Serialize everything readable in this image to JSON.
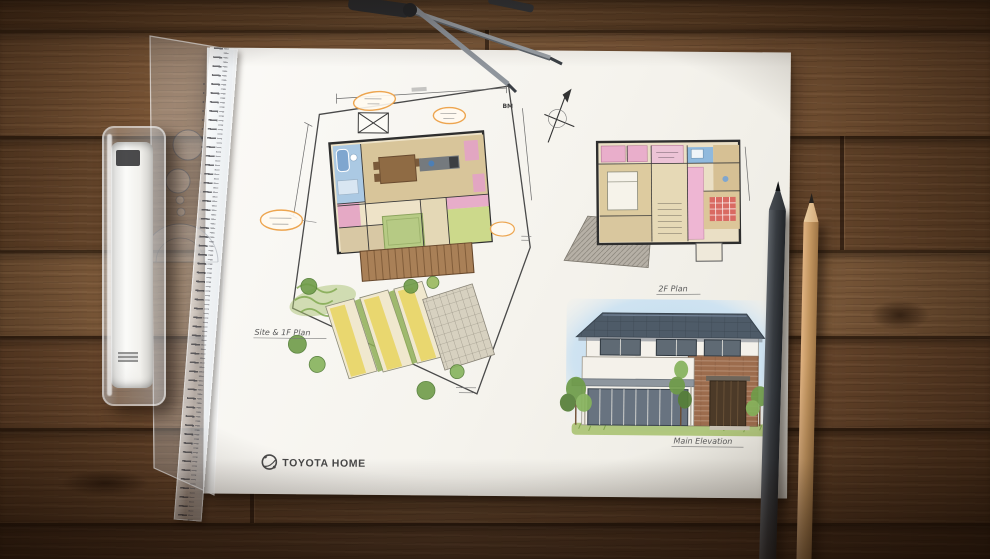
{
  "drawing": {
    "logo": {
      "text": "TOYOTA HOME"
    },
    "labels": {
      "site_plan": "Site & 1F Plan",
      "floor_2": "2F Plan",
      "elevation": "Main Elevation",
      "benchmark": "BM"
    }
  },
  "objects": {
    "tube": "document-tube",
    "template": "protractor-template",
    "ruler": "clear-ruler",
    "divider": "drafting-divider",
    "pencil_dark": "charcoal-pencil",
    "pencil_wood": "graphite-pencil"
  },
  "colors": {
    "wood": "#7b5334",
    "paper": "#f6f4ef",
    "roof": "#4e5b68",
    "brick": "#9c6c4d",
    "tatami": "#b7cb85",
    "deck": "#aa8158",
    "closet_pink": "#e9aecb",
    "bath_blue": "#a8c8e4",
    "balloon_orange": "#eda54f",
    "tree_green": "#6f9c49",
    "sky": "#c7dfef",
    "lawn": "#99b75f"
  }
}
